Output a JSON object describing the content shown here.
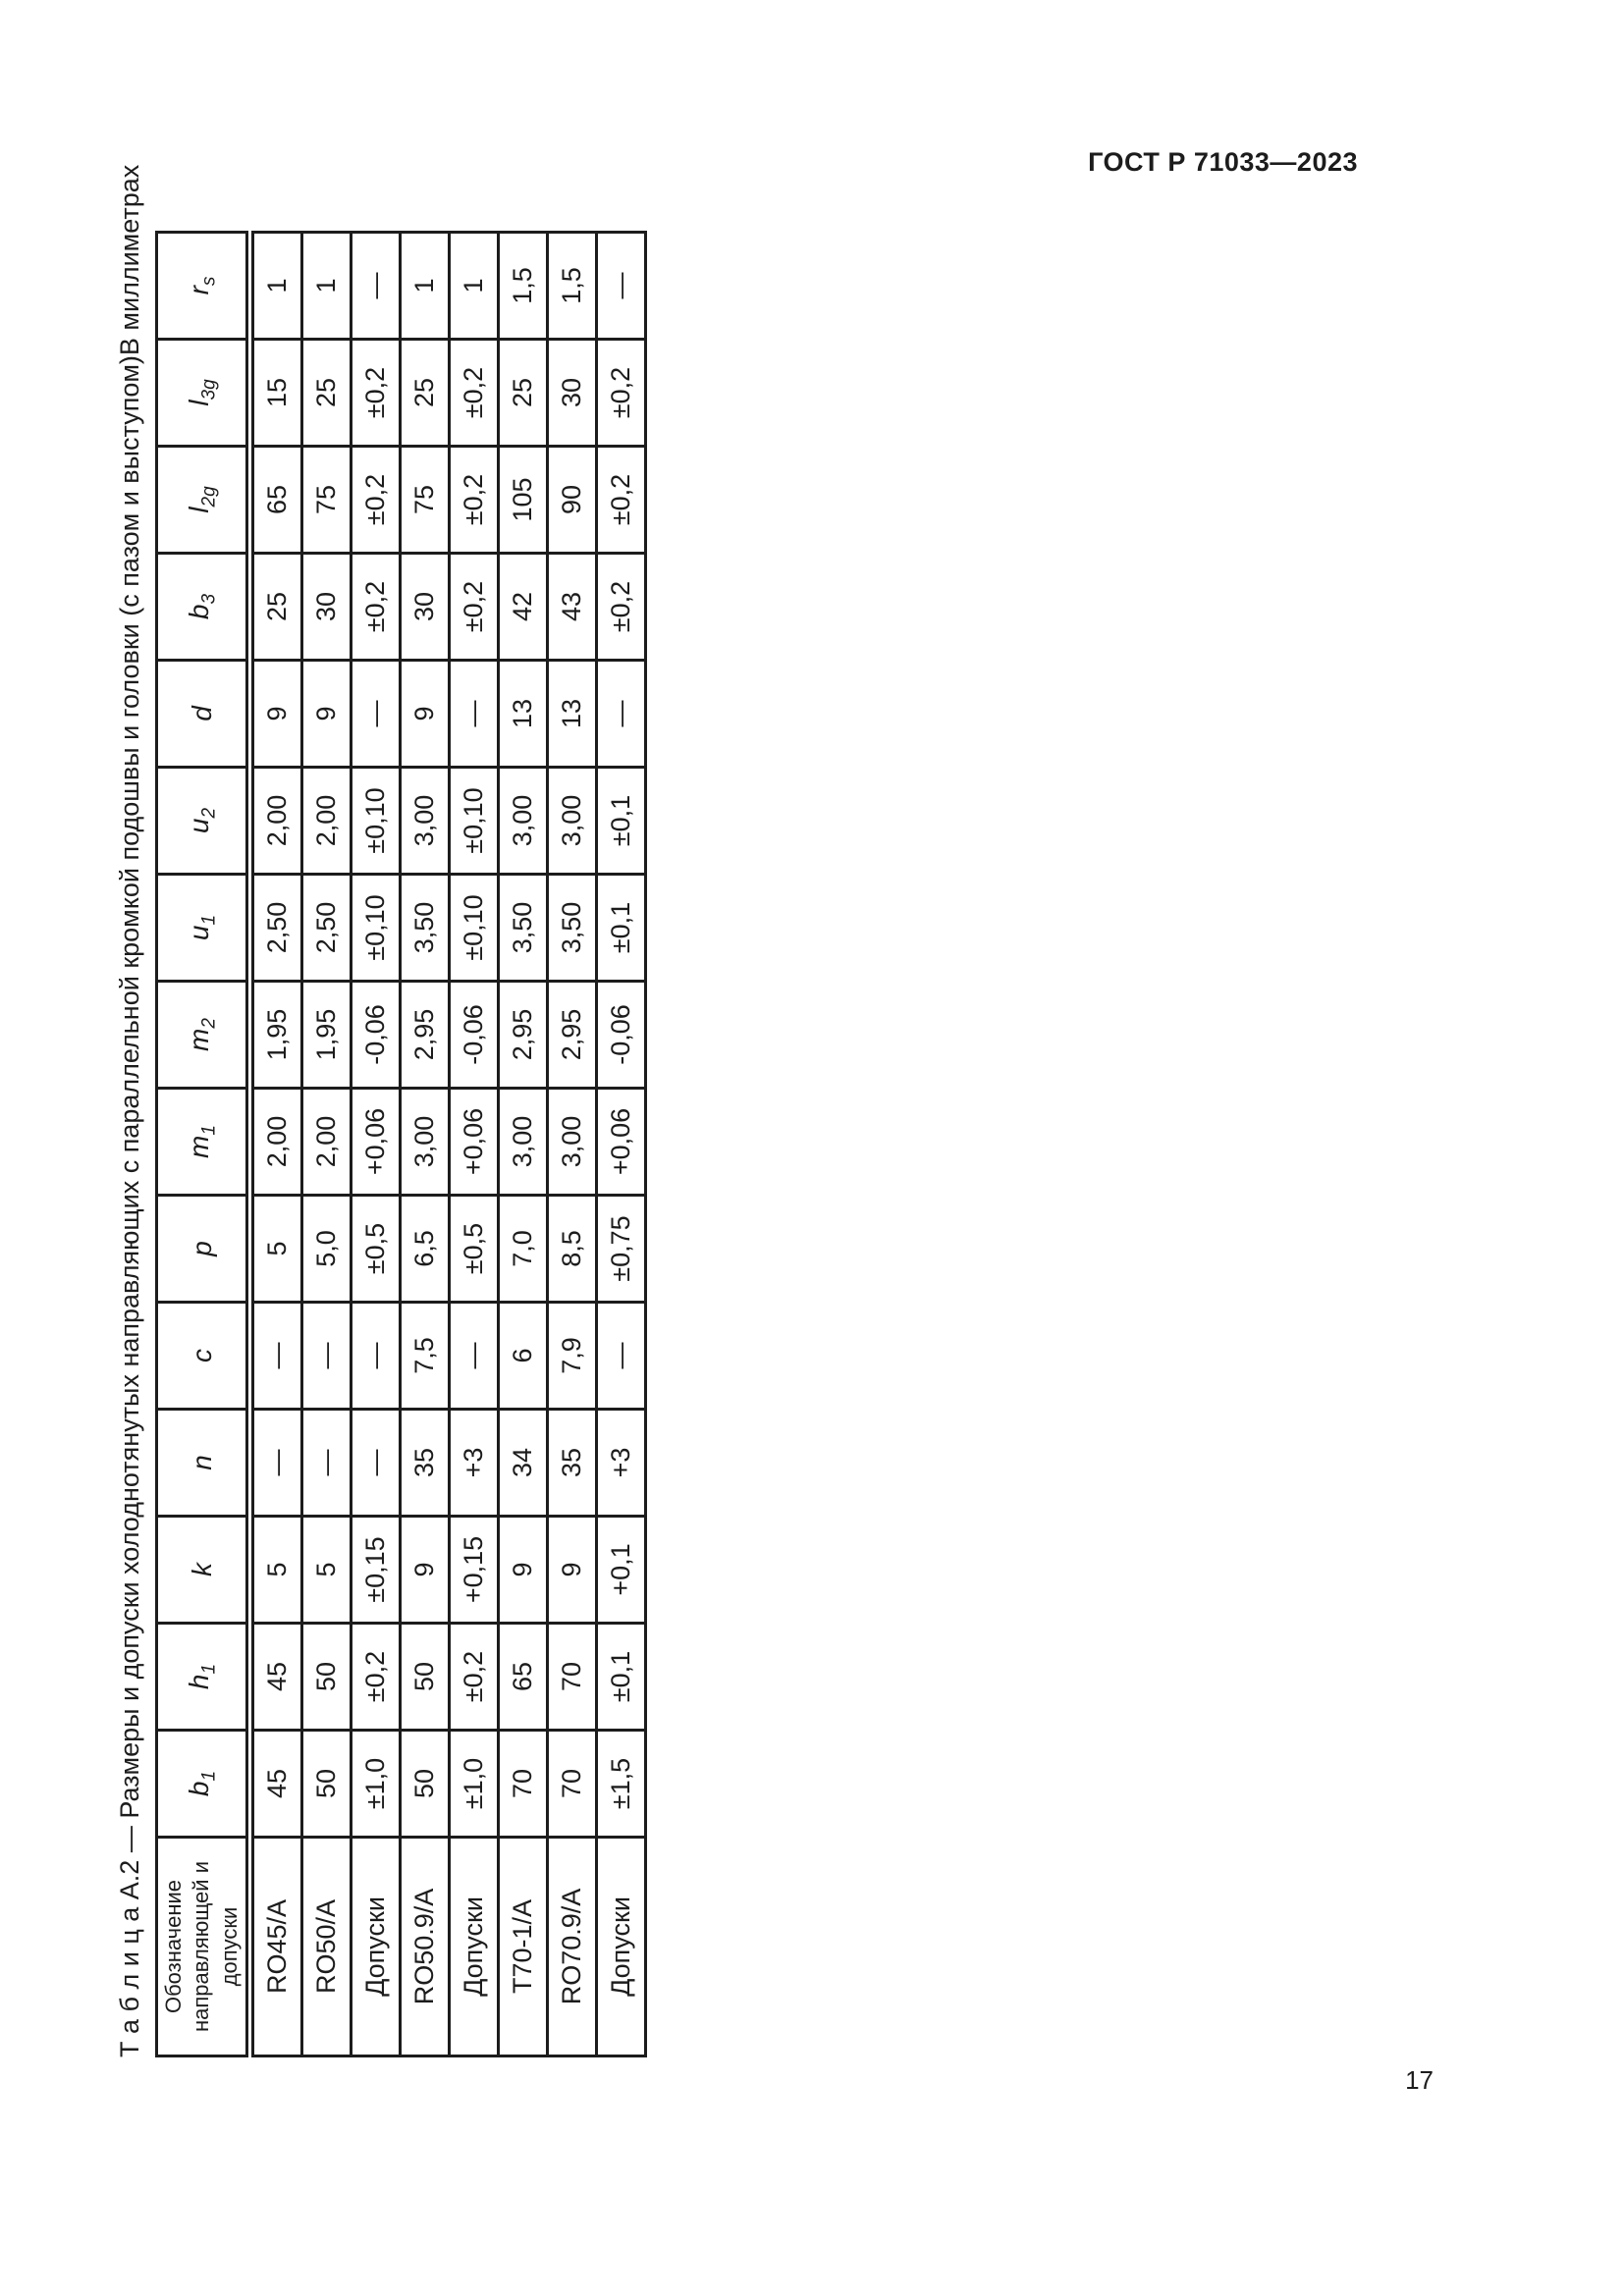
{
  "ink_color": "#1c1c1c",
  "page": {
    "header": "ГОСТ Р 71033—2023",
    "number": "17"
  },
  "caption": {
    "title": "Т а б л и ц а   А.2 — Размеры и допуски холоднотянутых направляющих с параллельной кромкой подошвы и головки (с пазом и выступом)",
    "units": "В миллиметрах"
  },
  "table": {
    "corner_header": "Обозначение направляющей и допуски",
    "columns": [
      {
        "base": "b",
        "sub": "1"
      },
      {
        "base": "h",
        "sub": "1"
      },
      {
        "base": "k",
        "sub": ""
      },
      {
        "base": "n",
        "sub": ""
      },
      {
        "base": "c",
        "sub": ""
      },
      {
        "base": "p",
        "sub": ""
      },
      {
        "base": "m",
        "sub": "1"
      },
      {
        "base": "m",
        "sub": "2"
      },
      {
        "base": "u",
        "sub": "1"
      },
      {
        "base": "u",
        "sub": "2"
      },
      {
        "base": "d",
        "sub": ""
      },
      {
        "base": "b",
        "sub": "3"
      },
      {
        "base": "l",
        "sub": "2g"
      },
      {
        "base": "l",
        "sub": "3g"
      },
      {
        "base": "r",
        "sub": "s"
      }
    ],
    "rows": [
      {
        "label": "RO45/A",
        "values": [
          "45",
          "45",
          "5",
          "—",
          "—",
          "5",
          "2,00",
          "1,95",
          "2,50",
          "2,00",
          "9",
          "25",
          "65",
          "15",
          "1"
        ]
      },
      {
        "label": "RO50/A",
        "values": [
          "50",
          "50",
          "5",
          "—",
          "—",
          "5,0",
          "2,00",
          "1,95",
          "2,50",
          "2,00",
          "9",
          "30",
          "75",
          "25",
          "1"
        ]
      },
      {
        "label": "Допуски",
        "values": [
          "±1,0",
          "±0,2",
          "±0,15",
          "—",
          "—",
          "±0,5",
          "+0,06",
          "-0,06",
          "±0,10",
          "±0,10",
          "—",
          "±0,2",
          "±0,2",
          "±0,2",
          "—"
        ]
      },
      {
        "label": "RO50.9/A",
        "values": [
          "50",
          "50",
          "9",
          "35",
          "7,5",
          "6,5",
          "3,00",
          "2,95",
          "3,50",
          "3,00",
          "9",
          "30",
          "75",
          "25",
          "1"
        ]
      },
      {
        "label": "Допуски",
        "values": [
          "±1,0",
          "±0,2",
          "+0,15",
          "+3",
          "—",
          "±0,5",
          "+0,06",
          "-0,06",
          "±0,10",
          "±0,10",
          "—",
          "±0,2",
          "±0,2",
          "±0,2",
          "1"
        ]
      },
      {
        "label": "Т70-1/А",
        "values": [
          "70",
          "65",
          "9",
          "34",
          "6",
          "7,0",
          "3,00",
          "2,95",
          "3,50",
          "3,00",
          "13",
          "42",
          "105",
          "25",
          "1,5"
        ]
      },
      {
        "label": "RO70.9/A",
        "values": [
          "70",
          "70",
          "9",
          "35",
          "7,9",
          "8,5",
          "3,00",
          "2,95",
          "3,50",
          "3,00",
          "13",
          "43",
          "90",
          "30",
          "1,5"
        ]
      },
      {
        "label": "Допуски",
        "values": [
          "±1,5",
          "±0,1",
          "+0,1",
          "+3",
          "—",
          "±0,75",
          "+0,06",
          "-0,06",
          "±0,1",
          "±0,1",
          "—",
          "±0,2",
          "±0,2",
          "±0,2",
          "—"
        ]
      }
    ]
  }
}
